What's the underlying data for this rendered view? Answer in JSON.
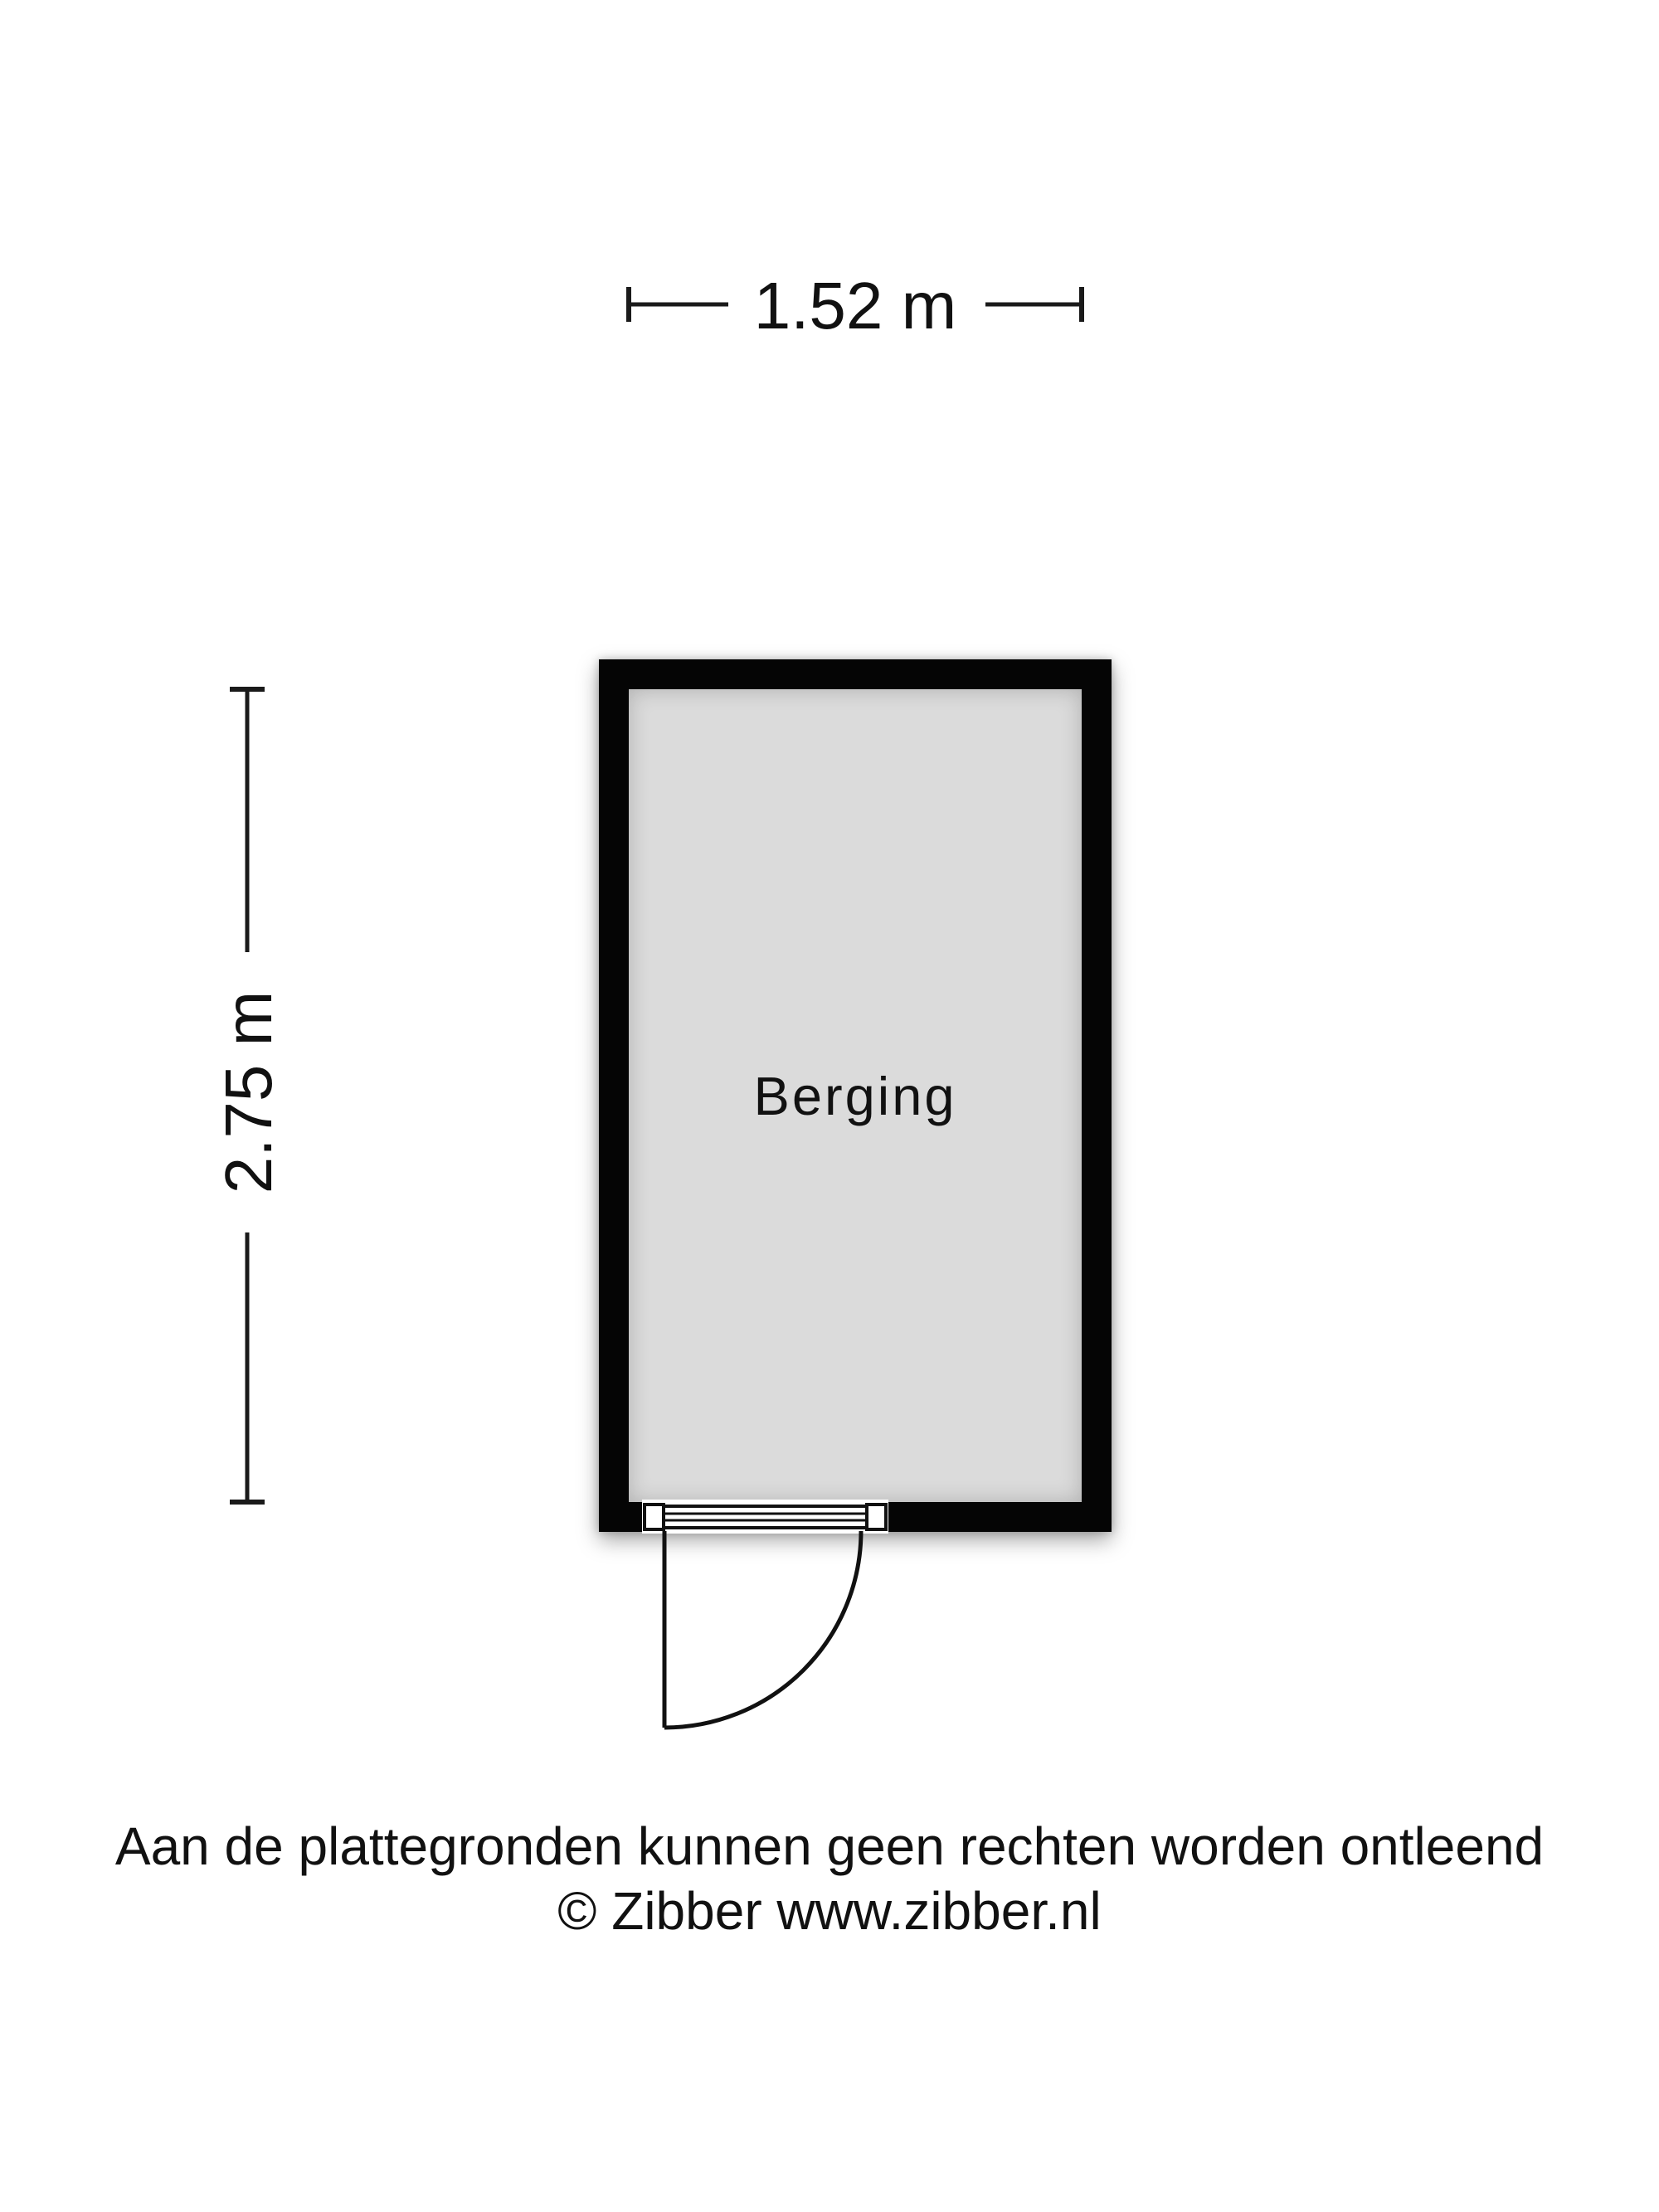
{
  "floorplan": {
    "room": {
      "label": "Berging"
    },
    "dimensions": {
      "width_label": "1.52 m",
      "height_label": "2.75 m"
    },
    "features": [
      "door-swing-bottom-wall"
    ]
  },
  "footer": {
    "disclaimer": "Aan de plattegronden kunnen geen rechten worden ontleend",
    "copyright": "© Zibber www.zibber.nl"
  },
  "colors": {
    "wall": "#050505",
    "room_fill": "#dbdbdb",
    "line": "#1a1a1a",
    "text": "#111111",
    "background": "#ffffff"
  }
}
